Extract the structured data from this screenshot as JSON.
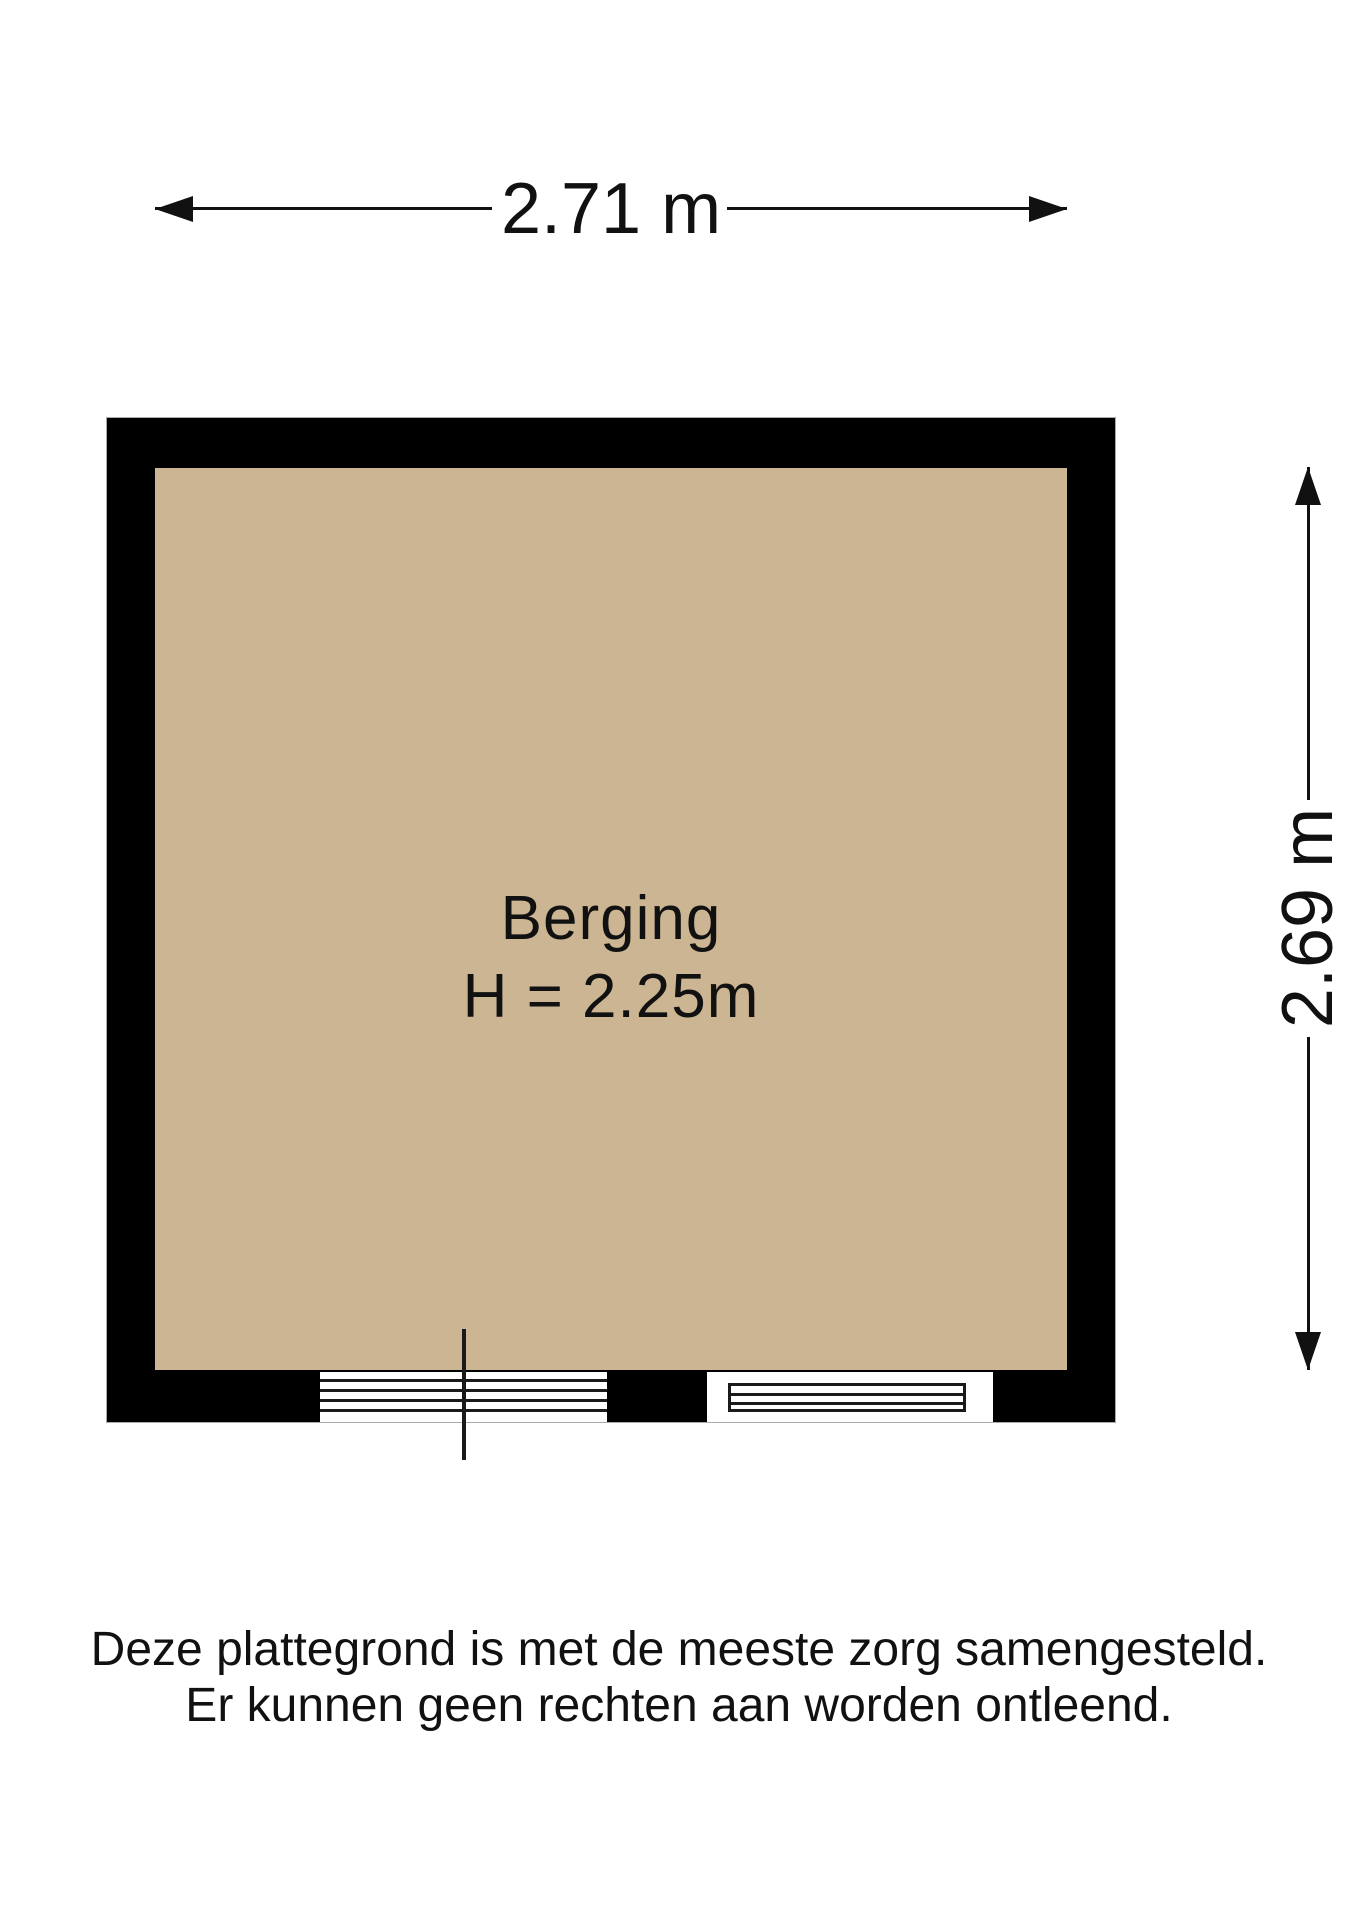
{
  "floorplan": {
    "room": {
      "name": "Berging",
      "ceiling_height": "H = 2.25m"
    },
    "dimensions": {
      "width": "2.71 m",
      "depth": "2.69 m"
    },
    "disclaimer": [
      "Deze plattegrond is met de meeste zorg samengesteld.",
      "Er kunnen geen rechten aan worden ontleend."
    ],
    "colors": {
      "floor": "#CBB592",
      "wall": "#000000",
      "line": "#1A1A1A",
      "background": "#FFFFFF"
    }
  }
}
